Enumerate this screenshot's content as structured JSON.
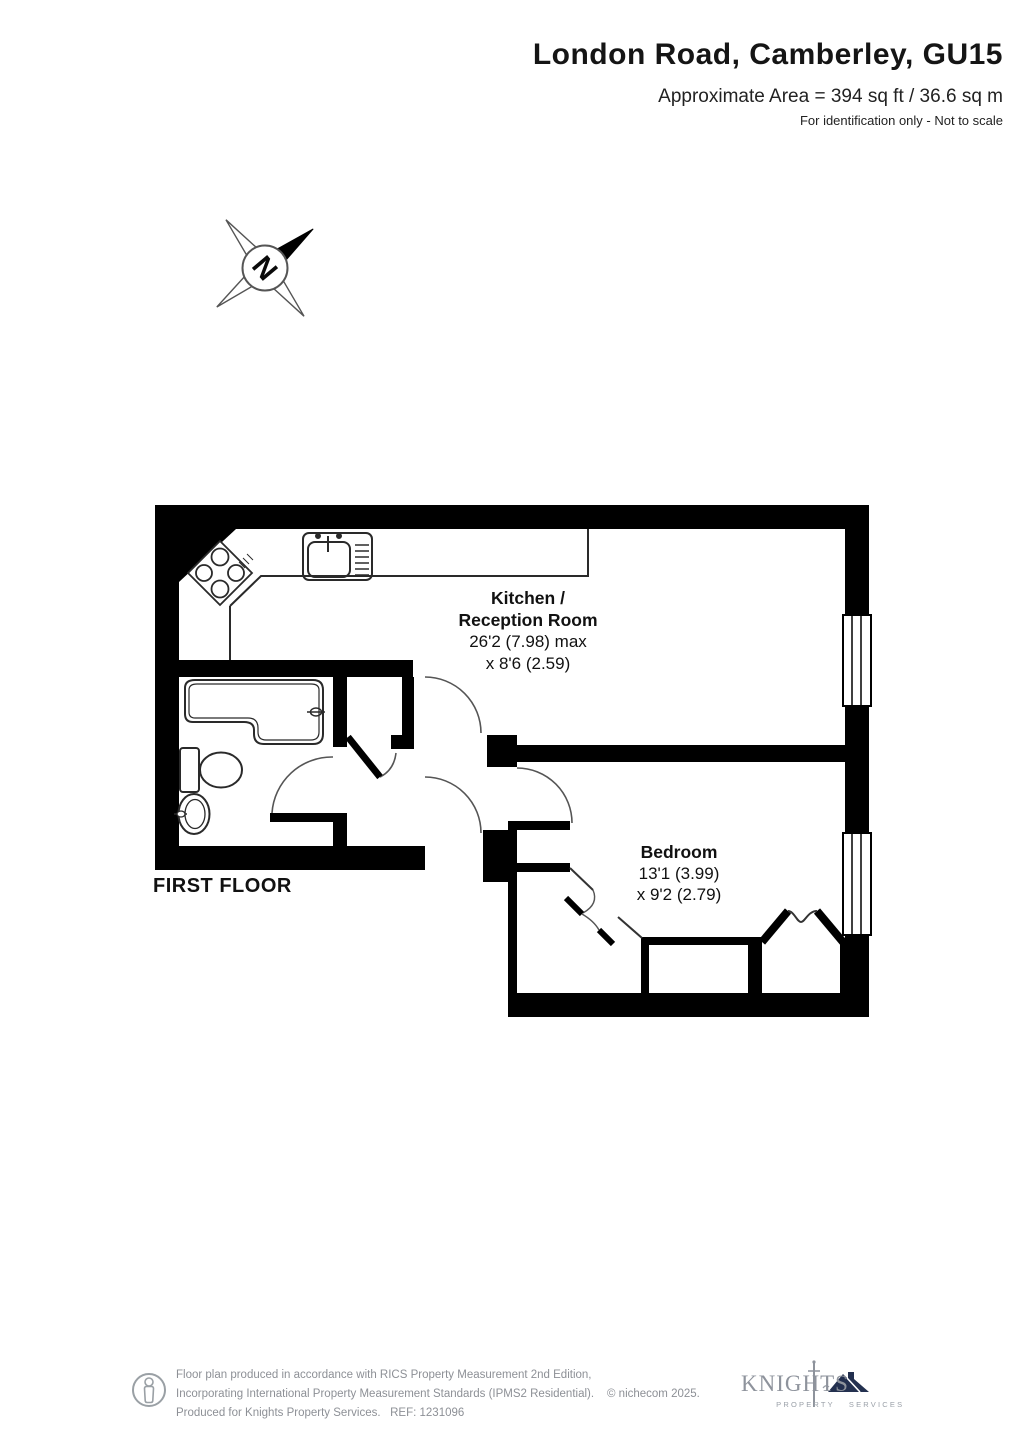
{
  "header": {
    "title": "London Road, Camberley, GU15",
    "area": "Approximate Area = 394 sq ft / 36.6 sq m",
    "note": "For identification only - Not to scale"
  },
  "compass": {
    "north_label": "N"
  },
  "plan": {
    "floor_label": "FIRST FLOOR",
    "rooms": {
      "kitchen": {
        "name_line1": "Kitchen /",
        "name_line2": "Reception Room",
        "dim_line1": "26'2 (7.98) max",
        "dim_line2": "x 8'6 (2.59)"
      },
      "bedroom": {
        "name": "Bedroom",
        "dim_line1": "13'1 (3.99)",
        "dim_line2": "x 9'2 (2.79)"
      }
    }
  },
  "footer": {
    "disclaimer_line1": "Floor plan produced in accordance with RICS Property Measurement 2nd Edition,",
    "disclaimer_line2": "Incorporating International Property Measurement Standards (IPMS2 Residential).",
    "copyright": "© nichecom 2025.",
    "disclaimer_line3": "Produced for Knights Property Services.   REF: 1231096",
    "logo": {
      "brand": "KNIGHTS",
      "sub_left": "PROPERTY",
      "sub_right": "SERVICES"
    }
  },
  "colors": {
    "wall": "#000000",
    "fixture_line": "#2a2a2a",
    "footer_text": "#8d9096",
    "logo_grey": "#8e939c",
    "logo_navy": "#23304f"
  }
}
